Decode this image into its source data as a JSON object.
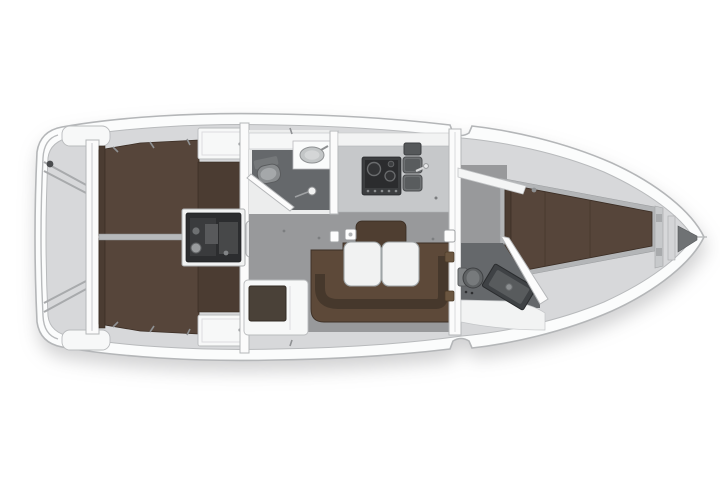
{
  "diagram": {
    "title": "Sailing yacht interior layout plan (top view)",
    "orientation": {
      "bow": "right",
      "stern": "left",
      "top_side": "port",
      "bottom_side": "starboard"
    },
    "colors": {
      "interior": "#d7d8da",
      "berth": "#56453a",
      "berthdark": "#4b3c32",
      "settee": "#5d4939",
      "band": "#46382c",
      "backrest": "#4f3e31",
      "floor": "#98999b",
      "cabinfloor": "#a9abad",
      "headfloor": "#65686b",
      "counter": "#c6c8ca",
      "table": "#f1f2f2",
      "engine": "#2c2d2f",
      "appliance": "#3c3e40",
      "hinge": "#6b5640",
      "hull_stroke": "#b4b6b8"
    },
    "areas": {
      "hull": {
        "label": "Hull outline"
      },
      "swim_platform": {
        "label": "Transom and swim platform"
      },
      "port_aft_cabin": {
        "label": "Aft double cabin (port)"
      },
      "starboard_aft_cabin": {
        "label": "Aft double cabin (starboard)"
      },
      "engine": {
        "label": "Engine compartment"
      },
      "companionway": {
        "label": "Companionway steps"
      },
      "aft_head": {
        "label": "Aft head with WC, basin and shower"
      },
      "galley": {
        "label": "Galley with stove and twin sinks"
      },
      "saloon": {
        "label": "Saloon"
      },
      "settee": {
        "label": "U-shaped settee"
      },
      "table": {
        "label": "Folding saloon table"
      },
      "nav_seat": {
        "label": "Navigation seat"
      },
      "forward_cabin": {
        "label": "Forward cabin with V-berth"
      },
      "forward_head": {
        "label": "Forward head (ensuite)"
      },
      "anchor_locker": {
        "label": "Anchor locker"
      },
      "mast_step": {
        "label": "Mast step"
      }
    }
  }
}
